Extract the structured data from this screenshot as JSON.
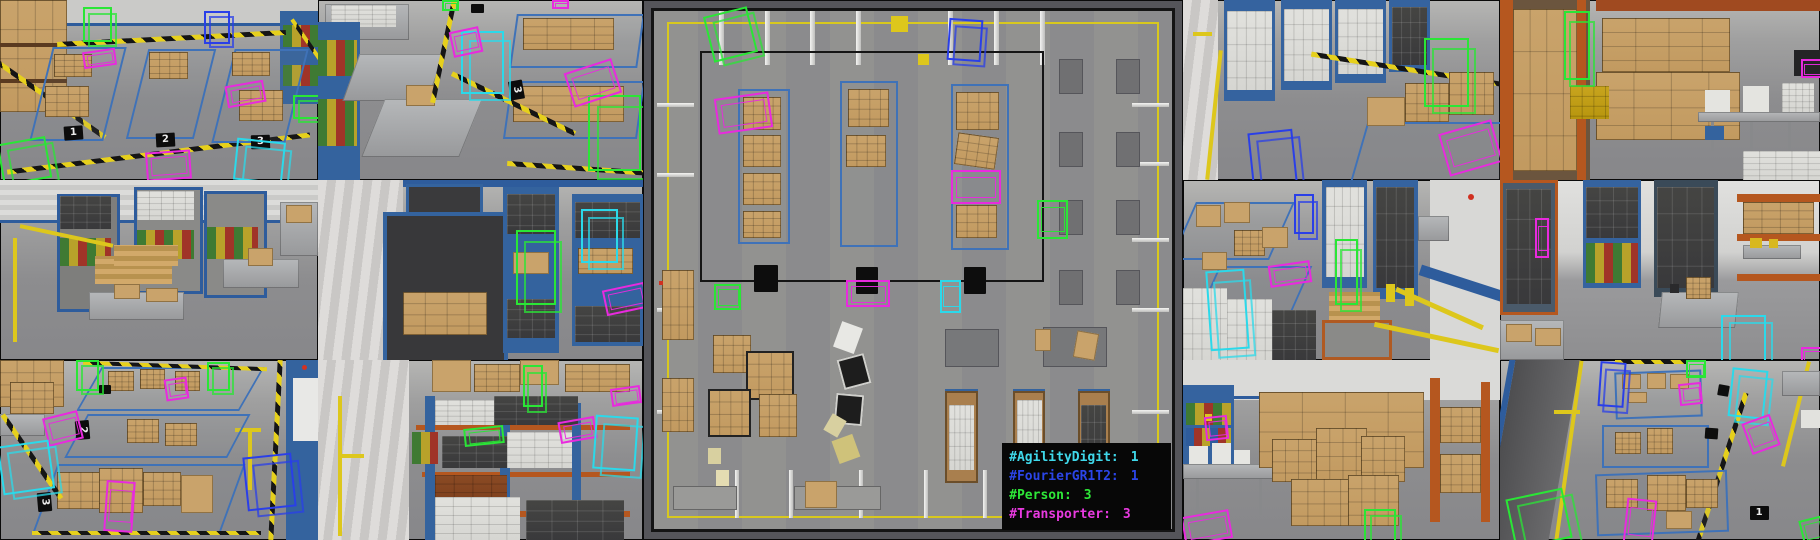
{
  "classes": {
    "AgilityDigit": "#2bd9ea",
    "FourierGR1T2": "#2a3fe8",
    "Person": "#2ae636",
    "Transporter": "#e82ade"
  },
  "legend": {
    "entries": [
      {
        "label": "#AgilityDigit:",
        "count": "1",
        "color": "#3fd8ea"
      },
      {
        "label": "#FourierGR1T2:",
        "count": "1",
        "color": "#2b45e8"
      },
      {
        "label": "#Person:",
        "count": "3",
        "color": "#2ee838"
      },
      {
        "label": "#Transporter:",
        "count": "3",
        "color": "#e83ae0"
      }
    ]
  },
  "tiles": [
    {
      "id": "L1",
      "detections": [
        {
          "cls": "Person",
          "shape": "cube",
          "x": 26,
          "y": 4,
          "w": 8,
          "h": 17
        },
        {
          "cls": "FourierGR1T2",
          "shape": "cube",
          "x": 64,
          "y": 6,
          "w": 7,
          "h": 16
        },
        {
          "cls": "Transporter",
          "shape": "flat",
          "x": 26,
          "y": 28,
          "w": 9,
          "h": 7,
          "rot": -8
        },
        {
          "cls": "Transporter",
          "shape": "flat",
          "x": 71,
          "y": 46,
          "w": 11,
          "h": 10,
          "rot": -10
        },
        {
          "cls": "Transporter",
          "shape": "flat",
          "x": 46,
          "y": 84,
          "w": 13,
          "h": 14,
          "rot": -4
        },
        {
          "cls": "Person",
          "shape": "cube",
          "x": 0,
          "y": 78,
          "w": 14,
          "h": 21,
          "rot": -10
        },
        {
          "cls": "AgilityDigit",
          "shape": "cube",
          "x": 74,
          "y": 78,
          "w": 14,
          "h": 21,
          "rot": 6
        },
        {
          "cls": "Person",
          "shape": "cube",
          "x": 92,
          "y": 53,
          "w": 8,
          "h": 11
        }
      ],
      "markers": [
        {
          "label": "1",
          "x": 20,
          "y": 70,
          "rot": -4
        },
        {
          "label": "2",
          "x": 49,
          "y": 74,
          "rot": -3
        },
        {
          "label": "3",
          "x": 79,
          "y": 75,
          "rot": -2
        }
      ]
    },
    {
      "id": "L2",
      "detections": [
        {
          "cls": "AgilityDigit",
          "shape": "cube",
          "x": 44,
          "y": 17,
          "w": 12,
          "h": 33
        },
        {
          "cls": "Transporter",
          "shape": "flat",
          "x": 41,
          "y": 16,
          "w": 8,
          "h": 12,
          "rot": -12
        },
        {
          "cls": "Person",
          "shape": "cube",
          "x": 83,
          "y": 53,
          "w": 15,
          "h": 40
        },
        {
          "cls": "Transporter",
          "shape": "flat",
          "x": 77,
          "y": 36,
          "w": 14,
          "h": 18,
          "rot": -18
        },
        {
          "cls": "Person",
          "shape": "flat",
          "x": 38,
          "y": 0,
          "w": 4,
          "h": 4
        },
        {
          "cls": "Transporter",
          "shape": "flat",
          "x": 72,
          "y": 0,
          "w": 4,
          "h": 3
        }
      ],
      "markers": [
        {
          "label": "3",
          "x": 58,
          "y": 46,
          "rot": 80
        }
      ]
    },
    {
      "id": "L3",
      "detections": [],
      "markers": []
    },
    {
      "id": "L4",
      "detections": [
        {
          "cls": "Person",
          "shape": "cube",
          "x": 61,
          "y": 28,
          "w": 11,
          "h": 39
        },
        {
          "cls": "AgilityDigit",
          "shape": "cube",
          "x": 81,
          "y": 16,
          "w": 10,
          "h": 28
        },
        {
          "cls": "Transporter",
          "shape": "flat",
          "x": 88,
          "y": 59,
          "w": 12,
          "h": 12,
          "rot": -12
        }
      ],
      "markers": []
    },
    {
      "id": "L5",
      "detections": [
        {
          "cls": "Person",
          "shape": "cube",
          "x": 24,
          "y": 0,
          "w": 6,
          "h": 15
        },
        {
          "cls": "Person",
          "shape": "cube",
          "x": 65,
          "y": 1,
          "w": 6,
          "h": 14
        },
        {
          "cls": "Transporter",
          "shape": "flat",
          "x": 14,
          "y": 30,
          "w": 10,
          "h": 14,
          "rot": -14
        },
        {
          "cls": "AgilityDigit",
          "shape": "cube",
          "x": 0,
          "y": 46,
          "w": 15,
          "h": 25,
          "rot": -8
        },
        {
          "cls": "Transporter",
          "shape": "flat",
          "x": 52,
          "y": 10,
          "w": 6,
          "h": 10,
          "rot": -8
        },
        {
          "cls": "Transporter",
          "shape": "flat",
          "x": 33,
          "y": 67,
          "w": 8,
          "h": 26,
          "rot": 4
        },
        {
          "cls": "FourierGR1T2",
          "shape": "cube",
          "x": 77,
          "y": 53,
          "w": 14,
          "h": 28,
          "rot": -6
        }
      ],
      "markers": [
        {
          "label": "2",
          "x": 23,
          "y": 35,
          "rot": 85
        },
        {
          "label": "3",
          "x": 11,
          "y": 75,
          "rot": 85
        }
      ]
    },
    {
      "id": "L6",
      "detections": [
        {
          "cls": "Person",
          "shape": "cube",
          "x": 63,
          "y": 3,
          "w": 5,
          "h": 21
        },
        {
          "cls": "Person",
          "shape": "flat",
          "x": 45,
          "y": 37,
          "w": 11,
          "h": 8,
          "rot": -6
        },
        {
          "cls": "Transporter",
          "shape": "flat",
          "x": 74,
          "y": 33,
          "w": 10,
          "h": 10,
          "rot": -10
        },
        {
          "cls": "AgilityDigit",
          "shape": "cube",
          "x": 85,
          "y": 31,
          "w": 12,
          "h": 28,
          "rot": 4
        },
        {
          "cls": "Transporter",
          "shape": "flat",
          "x": 90,
          "y": 15,
          "w": 8,
          "h": 8,
          "rot": -8
        }
      ],
      "markers": []
    },
    {
      "id": "C",
      "detections": [
        {
          "cls": "Person",
          "shape": "cube",
          "x": 12,
          "y": 2,
          "w": 7.5,
          "h": 8,
          "rot": -14
        },
        {
          "cls": "FourierGR1T2",
          "shape": "cube",
          "x": 56.5,
          "y": 3.5,
          "w": 5.5,
          "h": 7,
          "rot": 4
        },
        {
          "cls": "Transporter",
          "shape": "flat",
          "x": 13.5,
          "y": 17.5,
          "w": 9.5,
          "h": 6,
          "rot": -8
        },
        {
          "cls": "Transporter",
          "shape": "flat",
          "x": 57,
          "y": 31.5,
          "w": 8.5,
          "h": 5.5
        },
        {
          "cls": "Person",
          "shape": "flat",
          "x": 73,
          "y": 37,
          "w": 5,
          "h": 6.5
        },
        {
          "cls": "Person",
          "shape": "flat",
          "x": 13.2,
          "y": 52.5,
          "w": 4.2,
          "h": 4.2
        },
        {
          "cls": "Transporter",
          "shape": "flat",
          "x": 37.5,
          "y": 51.8,
          "w": 7.5,
          "h": 4.4
        },
        {
          "cls": "AgilityDigit",
          "shape": "flat",
          "x": 55,
          "y": 51.8,
          "w": 3.2,
          "h": 5.5
        }
      ],
      "markers": []
    },
    {
      "id": "R1",
      "detections": [
        {
          "cls": "Person",
          "shape": "cube",
          "x": 76,
          "y": 21,
          "w": 13,
          "h": 36
        },
        {
          "cls": "FourierGR1T2",
          "shape": "cube",
          "x": 21,
          "y": 73,
          "w": 13,
          "h": 27,
          "rot": -6
        },
        {
          "cls": "Transporter",
          "shape": "flat",
          "x": 82,
          "y": 70,
          "w": 16,
          "h": 22,
          "rot": -16
        }
      ],
      "markers": []
    },
    {
      "id": "R2",
      "detections": [
        {
          "cls": "Person",
          "shape": "cube",
          "x": 20,
          "y": 6,
          "w": 7,
          "h": 36
        },
        {
          "cls": "Transporter",
          "shape": "flat",
          "x": 94,
          "y": 33,
          "w": 6,
          "h": 8
        }
      ],
      "markers": []
    },
    {
      "id": "R3",
      "detections": [
        {
          "cls": "FourierGR1T2",
          "shape": "cube",
          "x": 35,
          "y": 8,
          "w": 5,
          "h": 20
        },
        {
          "cls": "Person",
          "shape": "cube",
          "x": 48,
          "y": 33,
          "w": 6,
          "h": 34
        },
        {
          "cls": "Transporter",
          "shape": "flat",
          "x": 27,
          "y": 46,
          "w": 12,
          "h": 10,
          "rot": -8
        },
        {
          "cls": "AgilityDigit",
          "shape": "cube",
          "x": 8,
          "y": 50,
          "w": 11,
          "h": 42,
          "rot": -4
        }
      ],
      "markers": []
    },
    {
      "id": "R4",
      "detections": [
        {
          "cls": "Transporter",
          "shape": "flat",
          "x": 11,
          "y": 21,
          "w": 3,
          "h": 20
        },
        {
          "cls": "AgilityDigit",
          "shape": "cube",
          "x": 69,
          "y": 75,
          "w": 13,
          "h": 25
        },
        {
          "cls": "Transporter",
          "shape": "flat",
          "x": 94,
          "y": 93,
          "w": 6,
          "h": 7
        }
      ],
      "markers": []
    },
    {
      "id": "R5",
      "detections": [
        {
          "cls": "Transporter",
          "shape": "flat",
          "x": 7,
          "y": 31,
          "w": 6,
          "h": 11,
          "rot": -6
        },
        {
          "cls": "Person",
          "shape": "cube",
          "x": 57,
          "y": 83,
          "w": 9,
          "h": 17
        },
        {
          "cls": "Transporter",
          "shape": "flat",
          "x": 0,
          "y": 85,
          "w": 14,
          "h": 14,
          "rot": -10
        }
      ],
      "markers": []
    },
    {
      "id": "R6",
      "detections": [
        {
          "cls": "FourierGR1T2",
          "shape": "cube",
          "x": 31,
          "y": 1,
          "w": 7,
          "h": 23,
          "rot": 4
        },
        {
          "cls": "Person",
          "shape": "flat",
          "x": 58,
          "y": 0,
          "w": 5,
          "h": 8
        },
        {
          "cls": "AgilityDigit",
          "shape": "cube",
          "x": 72,
          "y": 5,
          "w": 10,
          "h": 25,
          "rot": 6
        },
        {
          "cls": "Transporter",
          "shape": "flat",
          "x": 56,
          "y": 13,
          "w": 6,
          "h": 10,
          "rot": -6
        },
        {
          "cls": "Transporter",
          "shape": "flat",
          "x": 77,
          "y": 32,
          "w": 8,
          "h": 16,
          "rot": -20
        },
        {
          "cls": "Transporter",
          "shape": "flat",
          "x": 39,
          "y": 77,
          "w": 8,
          "h": 23,
          "rot": 6
        },
        {
          "cls": "Person",
          "shape": "cube",
          "x": 3,
          "y": 74,
          "w": 17,
          "h": 26,
          "rot": -12
        },
        {
          "cls": "Person",
          "shape": "flat",
          "x": 94,
          "y": 88,
          "w": 6,
          "h": 12,
          "rot": -14
        }
      ],
      "markers": [
        {
          "label": "1",
          "x": 78,
          "y": 81,
          "rot": 0
        }
      ]
    }
  ]
}
